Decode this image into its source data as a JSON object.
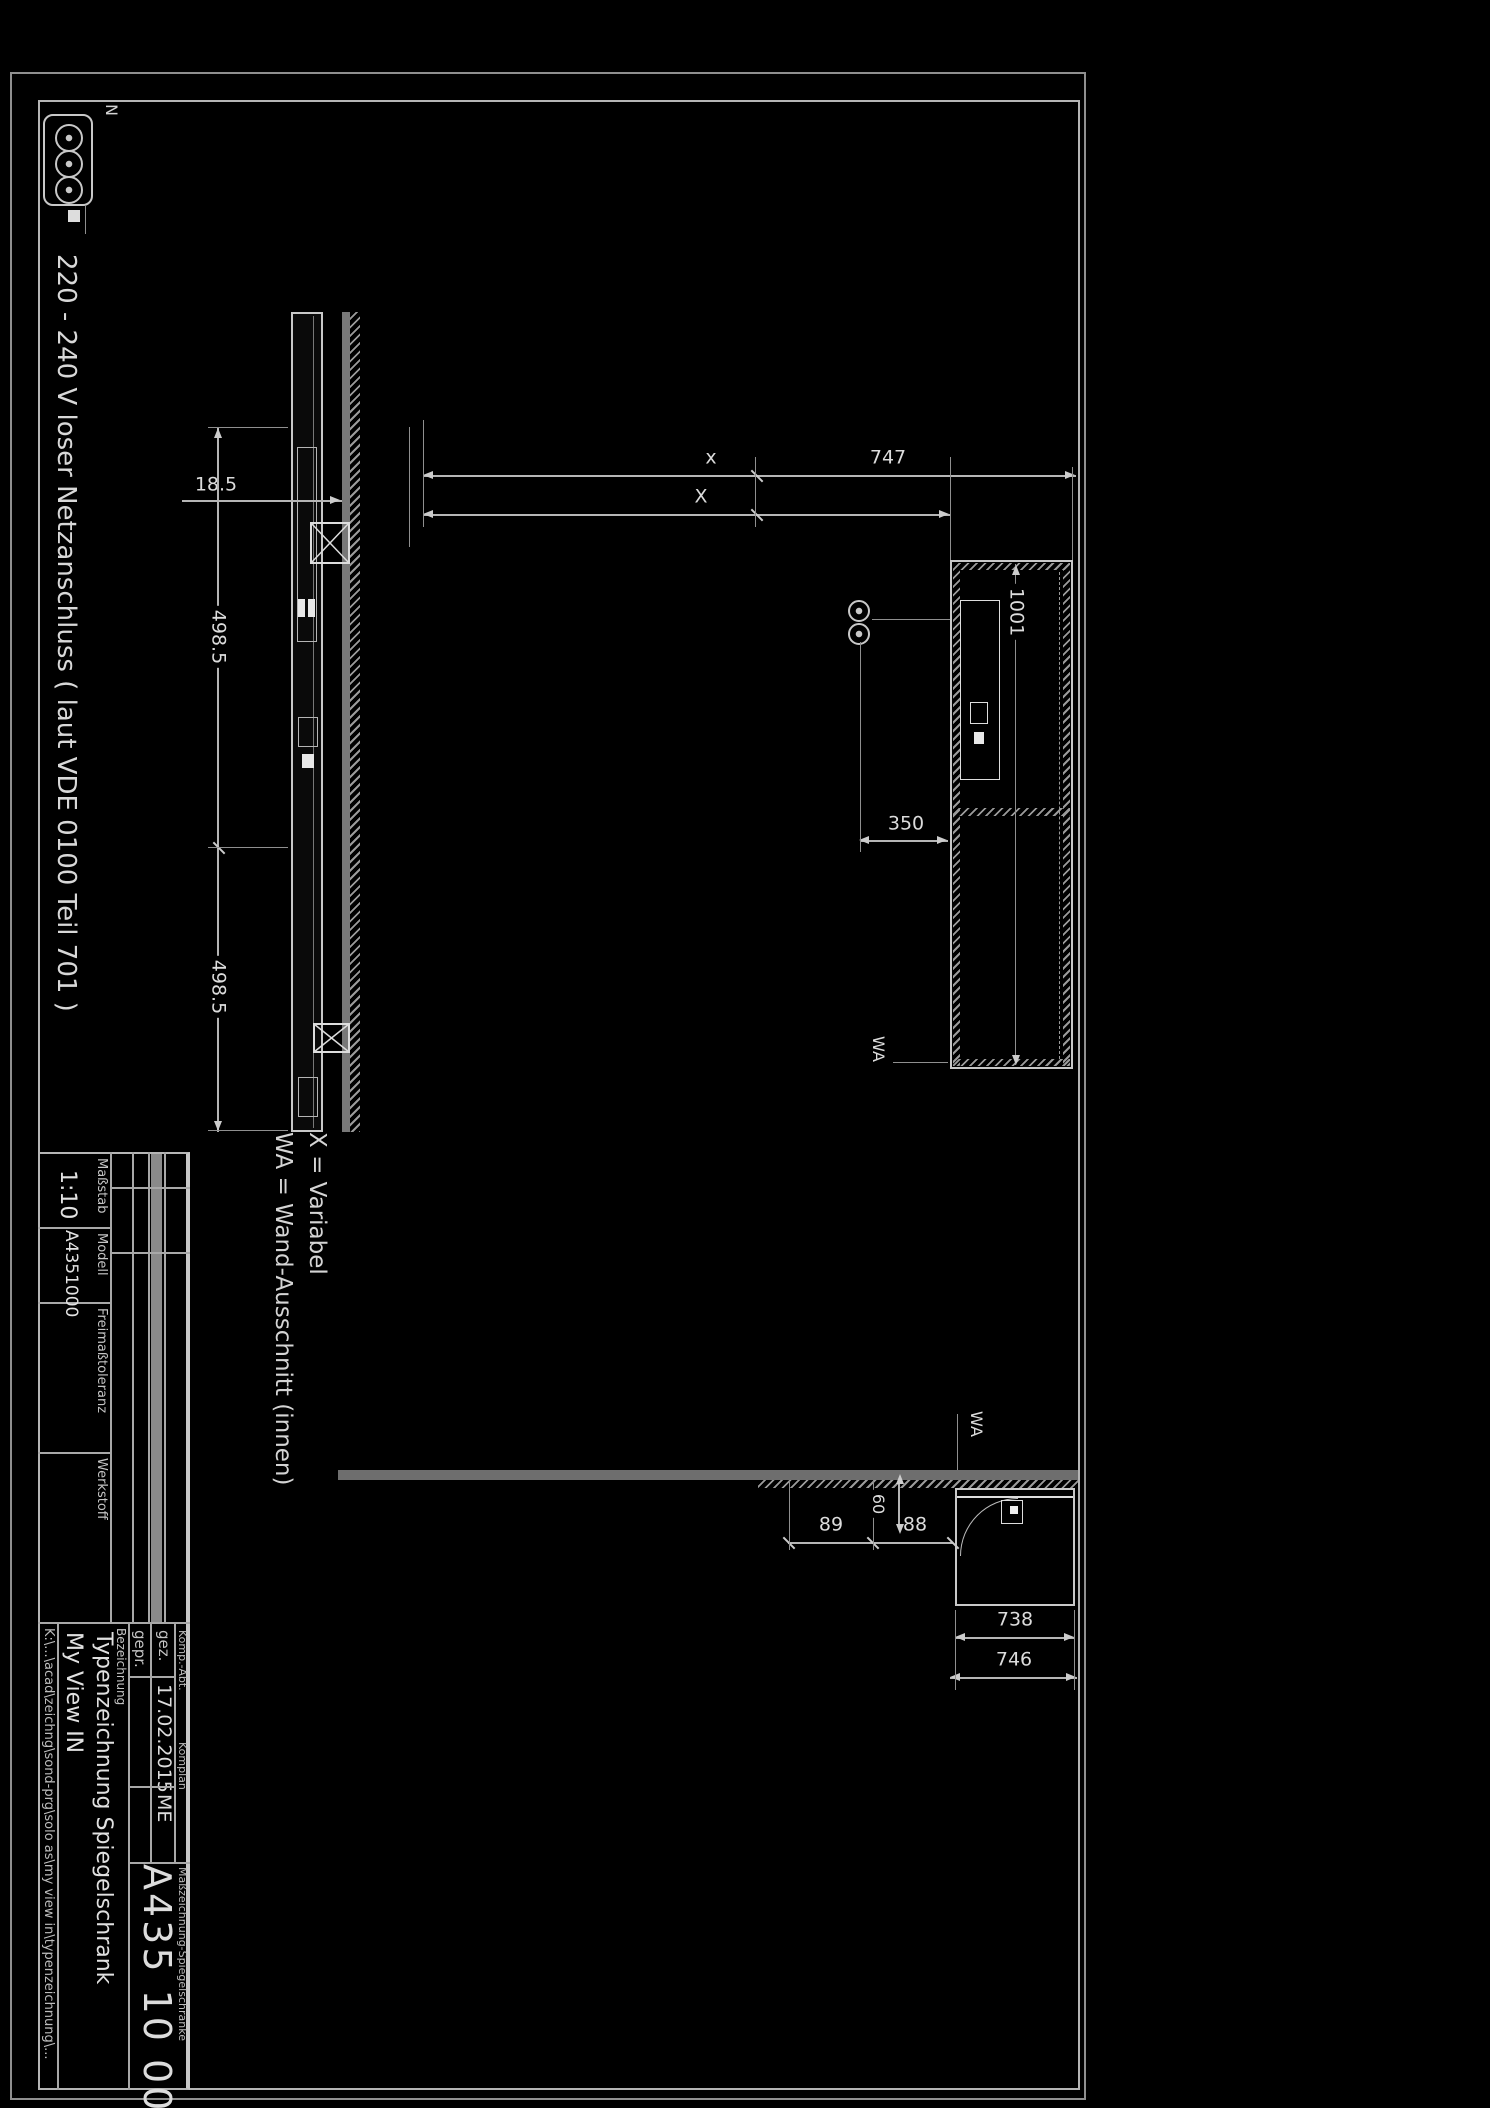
{
  "note": {
    "text": "220 - 240 V loser Netzanschluss ( laut VDE 0100 Teil 701 )",
    "n": "N"
  },
  "legend": {
    "line1": "X = Variabel",
    "line2": "WA = Wand-Ausschnitt (innen)"
  },
  "dims": {
    "door_depth": "18.5",
    "door_width_left": "498.5",
    "door_width_right": "498.5",
    "total_height": "x",
    "variable_offset": "X",
    "niche_747": "747",
    "niche_1001": "1001",
    "socket_350": "350",
    "side_738": "738",
    "side_746": "746",
    "clear_88": "88",
    "clear_89": "89",
    "depth_60": "60",
    "wa_side": "WA",
    "wa_front": "WA"
  },
  "titleblock": {
    "scale_label": "Maßstab",
    "scale_value": "1:10",
    "model_label": "Modell",
    "model_value": "A4351000",
    "tolerance_label": "Freimaßtoleranz",
    "material_label": "Werkstoff",
    "drawn_label": "gez.",
    "drawn_date": "17.02.2015",
    "drawn_by": "ME",
    "checked_label": "gepr.",
    "designation_label": "Bezeichnung",
    "designation_line1": "Typenzeichnung Spiegelschrank",
    "designation_line2": "My View IN",
    "dept_label": "Komp.-Abt.",
    "dept_value": "Komplan",
    "series_label": "Maßzeichnung-Spiegelschränke",
    "drawing_number": "A435 10 00",
    "file_path": "K:\\...\\acad\\zeichng\\sond-prg\\solo as\\my view in\\typenzeichnung\\..."
  }
}
